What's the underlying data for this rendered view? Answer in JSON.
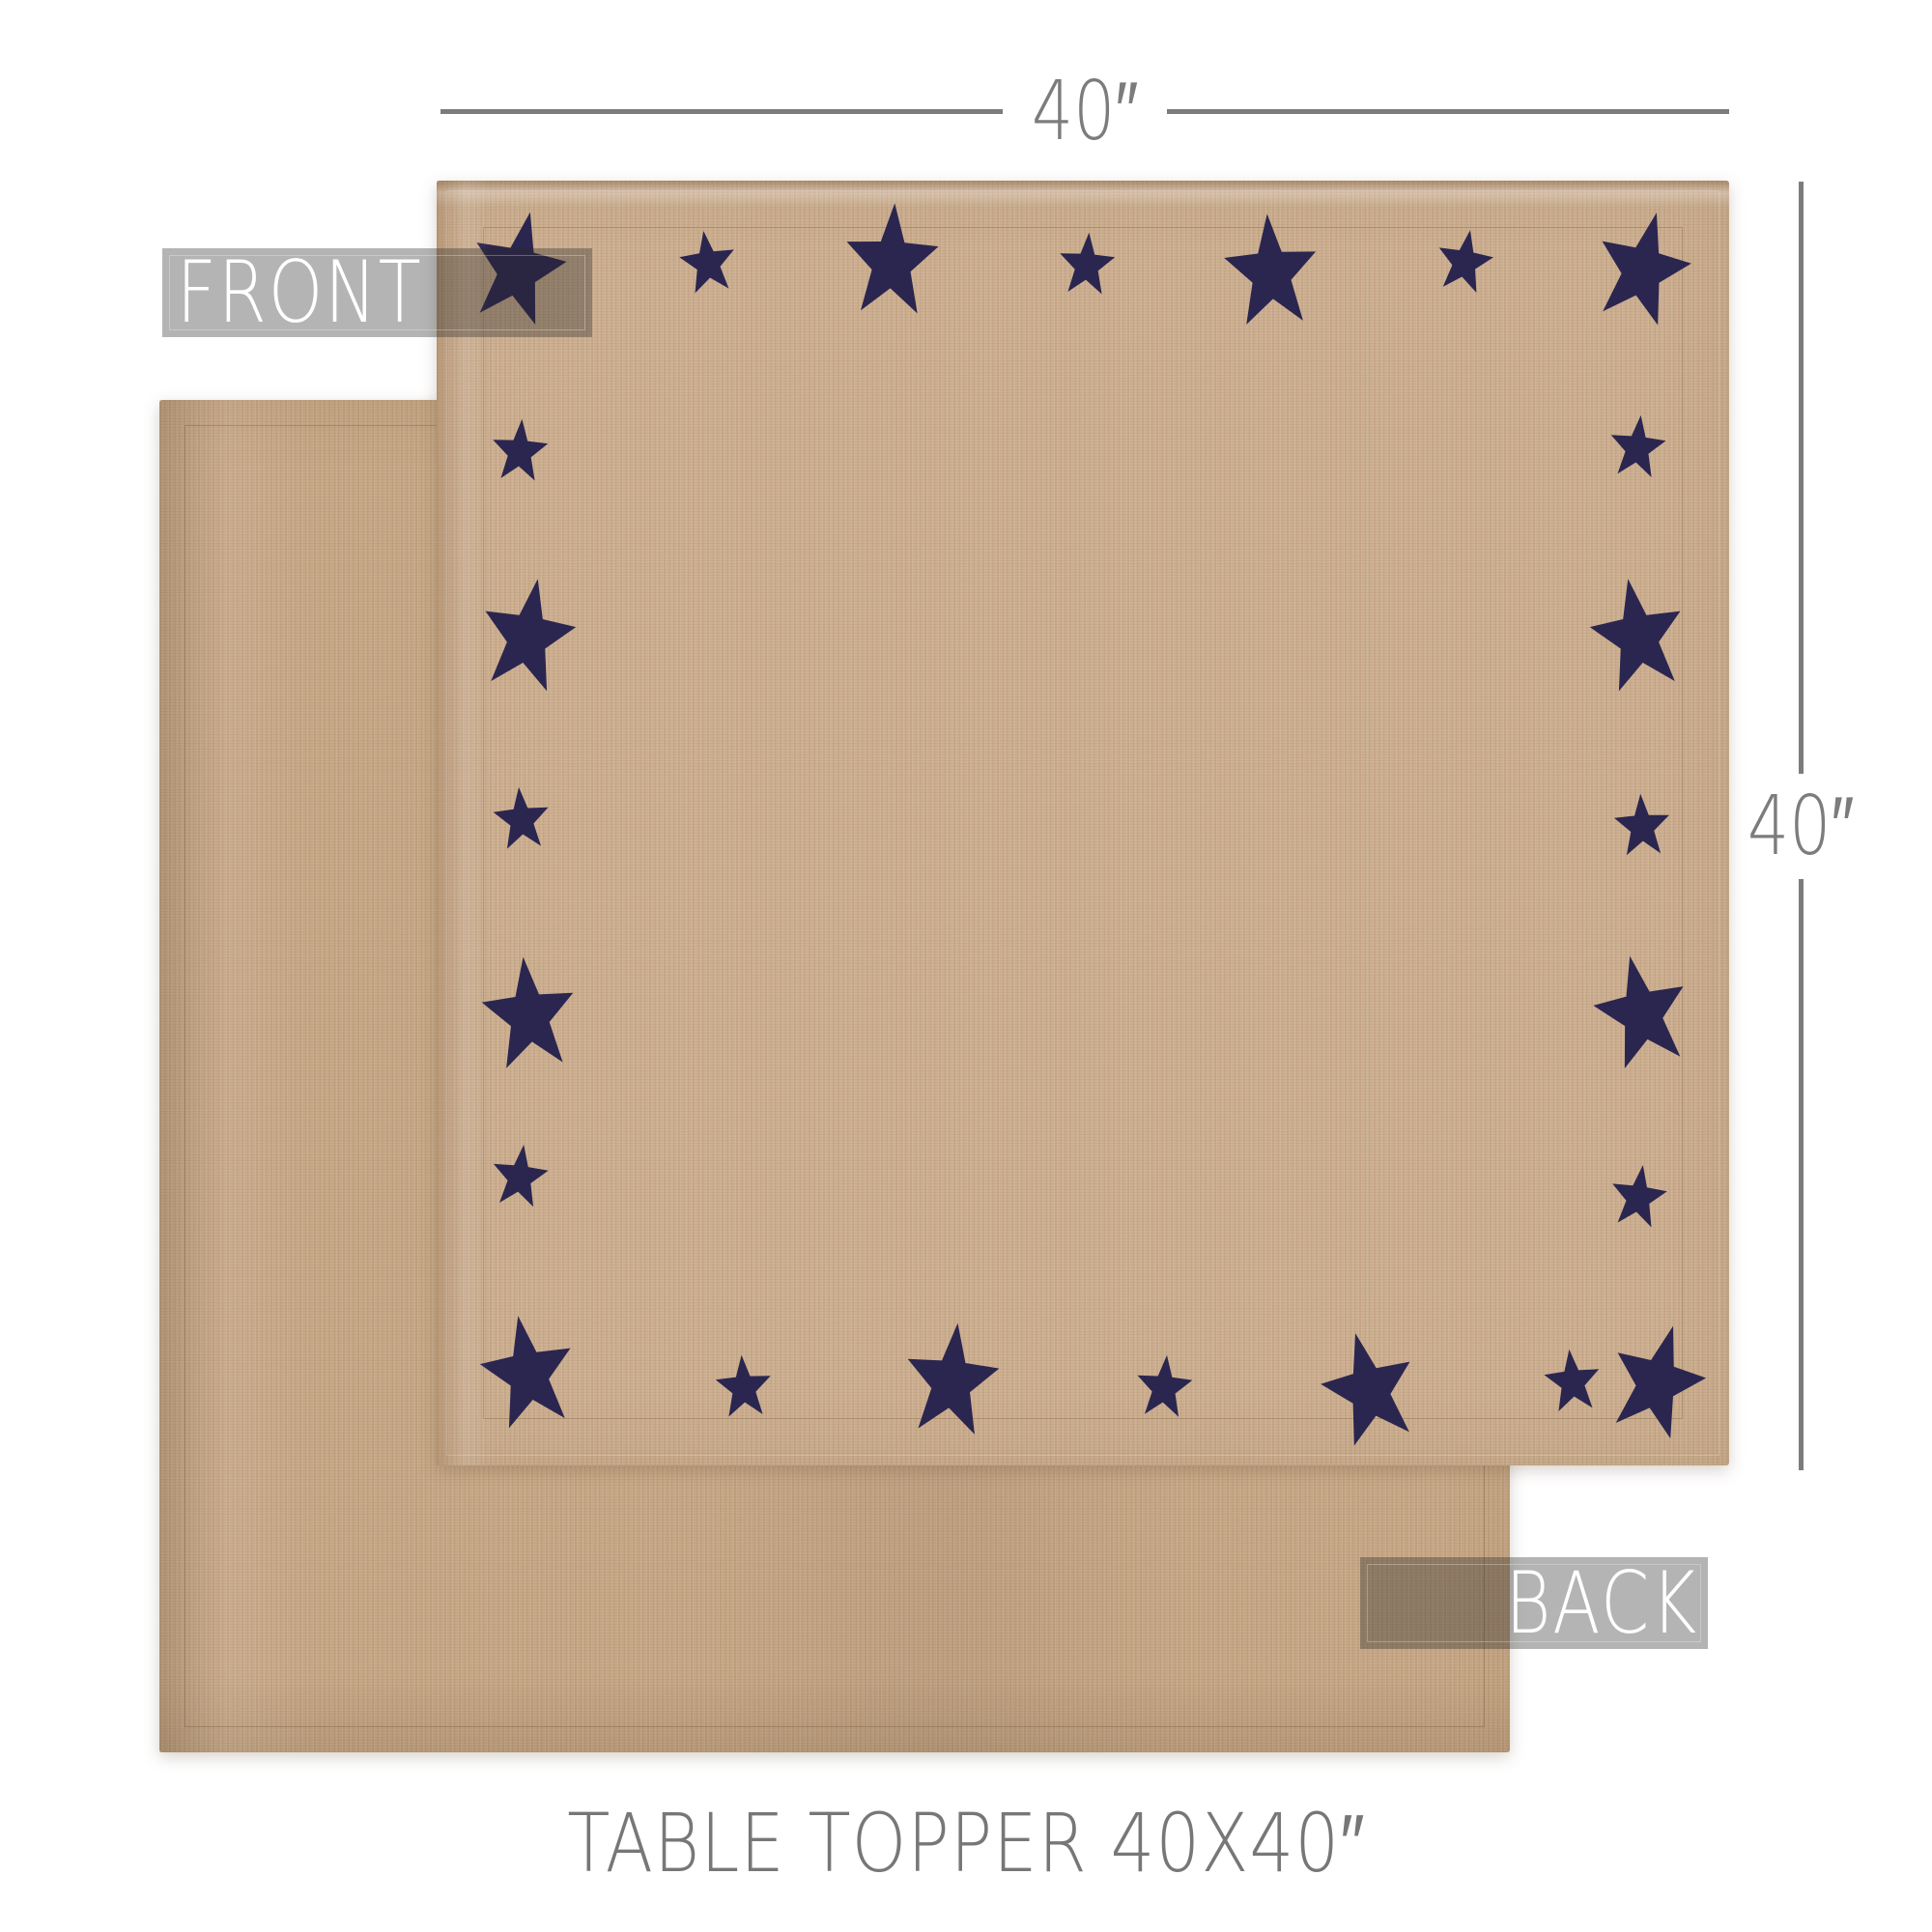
{
  "labels": {
    "front": "FRONT",
    "back": "BACK"
  },
  "dimensions": {
    "width_label": "40″",
    "height_label": "40″"
  },
  "caption": {
    "text": "TABLE TOPPER 40X40″"
  },
  "colors": {
    "dimension": "#7c7c7c",
    "caption": "#777777",
    "band-bg": "rgba(40,40,40,0.35)",
    "band-text": "#ffffff",
    "front-fabric": "#cbad8e",
    "back-fabric": "#c5a583",
    "star": "#2b264f"
  },
  "front_cloth": {
    "star_sizes": {
      "large": [
        100,
        126
      ],
      "small": [
        60,
        70
      ]
    },
    "stars": [
      {
        "size": "large",
        "x": 6.3,
        "y": 7.0,
        "rot": 12
      },
      {
        "size": "small",
        "x": 21.0,
        "y": 6.5,
        "rot": -8
      },
      {
        "size": "large",
        "x": 35.2,
        "y": 6.4,
        "rot": 3
      },
      {
        "size": "small",
        "x": 50.3,
        "y": 6.6,
        "rot": 4
      },
      {
        "size": "large",
        "x": 64.6,
        "y": 7.2,
        "rot": -4
      },
      {
        "size": "small",
        "x": 79.5,
        "y": 6.4,
        "rot": 10
      },
      {
        "size": "large",
        "x": 93.3,
        "y": 7.0,
        "rot": 14
      },
      {
        "size": "small",
        "x": 92.9,
        "y": 20.8,
        "rot": 6
      },
      {
        "size": "large",
        "x": 93.0,
        "y": 35.6,
        "rot": -10
      },
      {
        "size": "small",
        "x": 93.3,
        "y": 50.3,
        "rot": -3
      },
      {
        "size": "large",
        "x": 93.3,
        "y": 64.9,
        "rot": -12
      },
      {
        "size": "small",
        "x": 93.0,
        "y": 79.2,
        "rot": 8
      },
      {
        "size": "large",
        "x": 94.4,
        "y": 93.6,
        "rot": 16
      },
      {
        "size": "small",
        "x": 87.9,
        "y": 93.5,
        "rot": -6
      },
      {
        "size": "large",
        "x": 72.2,
        "y": 94.2,
        "rot": -14
      },
      {
        "size": "small",
        "x": 56.3,
        "y": 94.0,
        "rot": 5
      },
      {
        "size": "large",
        "x": 39.8,
        "y": 93.5,
        "rot": 6
      },
      {
        "size": "small",
        "x": 23.8,
        "y": 94.0,
        "rot": -4
      },
      {
        "size": "large",
        "x": 7.1,
        "y": 92.9,
        "rot": -10
      },
      {
        "size": "small",
        "x": 6.4,
        "y": 77.6,
        "rot": 7
      },
      {
        "size": "large",
        "x": 7.2,
        "y": 65.0,
        "rot": -6
      },
      {
        "size": "small",
        "x": 6.6,
        "y": 49.8,
        "rot": -5
      },
      {
        "size": "large",
        "x": 7.0,
        "y": 35.6,
        "rot": 10
      },
      {
        "size": "small",
        "x": 6.4,
        "y": 21.1,
        "rot": 4
      }
    ]
  }
}
